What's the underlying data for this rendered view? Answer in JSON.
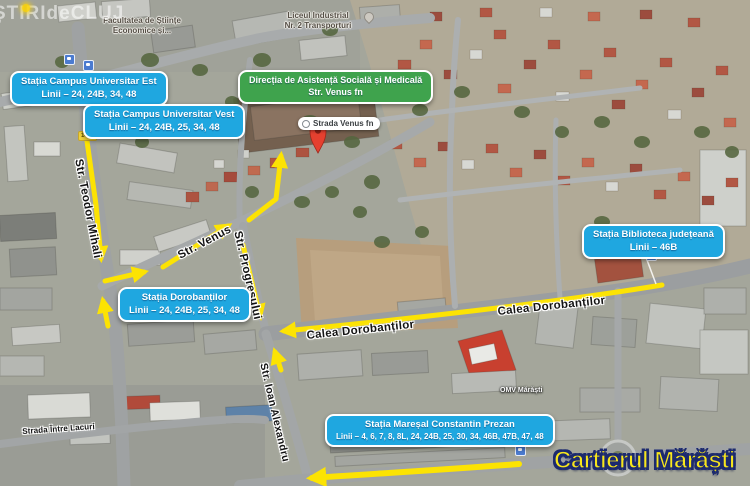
{
  "watermark": {
    "text": "ȘTIRIdeCLUJ"
  },
  "title": {
    "text": "Cartierul Mărăști"
  },
  "stations": {
    "campus_est": {
      "name": "Stația Campus Universitar Est",
      "lines": "Linii – 24, 24B, 34, 48"
    },
    "campus_vest": {
      "name": "Stația Campus Universitar Vest",
      "lines": "Linii – 24, 24B, 25, 34, 48"
    },
    "dorobantilor": {
      "name": "Stația Dorobanților",
      "lines": "Linii – 24, 24B, 25, 34, 48"
    },
    "biblioteca": {
      "name": "Stația Biblioteca județeană",
      "lines": "Linii – 46B"
    },
    "prezan": {
      "name": "Stația Mareșal Constantin Prezan",
      "lines": "Linii – 4, 6, 7, 8, 8L, 24, 24B, 25, 30, 34, 46B, 47B, 47, 48"
    }
  },
  "destination": {
    "name": "Direcția de Asistență Socială și Medicală",
    "address": "Str. Venus fn"
  },
  "place_marker": {
    "label": "Strada Venus fn"
  },
  "streets": {
    "teodor_mihali": "Str. Teodor Mihali",
    "venus": "Str. Venus",
    "progresului": "Str. Progresului",
    "dorobantilor_west": "Calea Dorobanților",
    "dorobantilor_east": "Calea Dorobanților",
    "ioan_alexandru": "Str. Ioan Alexandru",
    "intre_lacuri": "Strada Între Lacuri"
  },
  "map_labels": {
    "facultatea_line1": "Facultatea de Științe",
    "facultatea_line2": "Economice și...",
    "liceul_line1": "Liceul Industrial",
    "liceul_line2": "Nr. 2 Transporturi",
    "omv": "OMV Mărăști",
    "road_badge": "1420"
  },
  "colors": {
    "route_arrow": "#fce303",
    "station_box": "#1fa7e0",
    "direction_box": "#3fa34d",
    "title_fill": "#f8e71c",
    "title_outline": "#1c2a6e",
    "marker_pin": "#e5402f"
  }
}
